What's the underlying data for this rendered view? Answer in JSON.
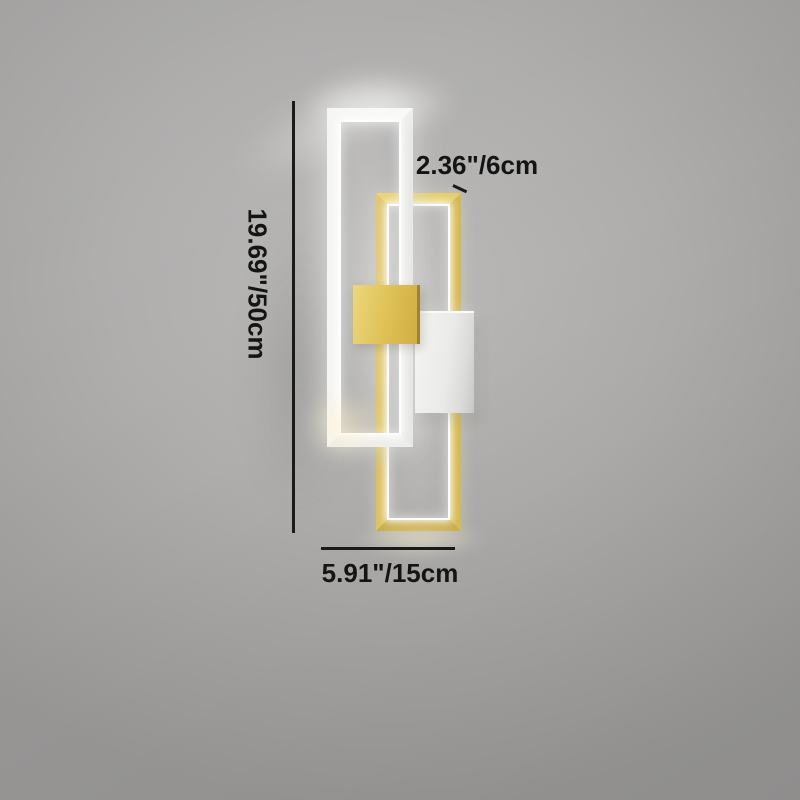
{
  "annotations": {
    "height_label": "19.69\"/50cm",
    "depth_label": "2.36\"/6cm",
    "width_label": "5.91\"/15cm"
  },
  "colors": {
    "gold_accent": "#d5b84f",
    "white_frame": "#f5f5f3",
    "wall_gray": "#aaa9a8",
    "annotation_text": "#141414",
    "led_glow": "#ffffff"
  }
}
